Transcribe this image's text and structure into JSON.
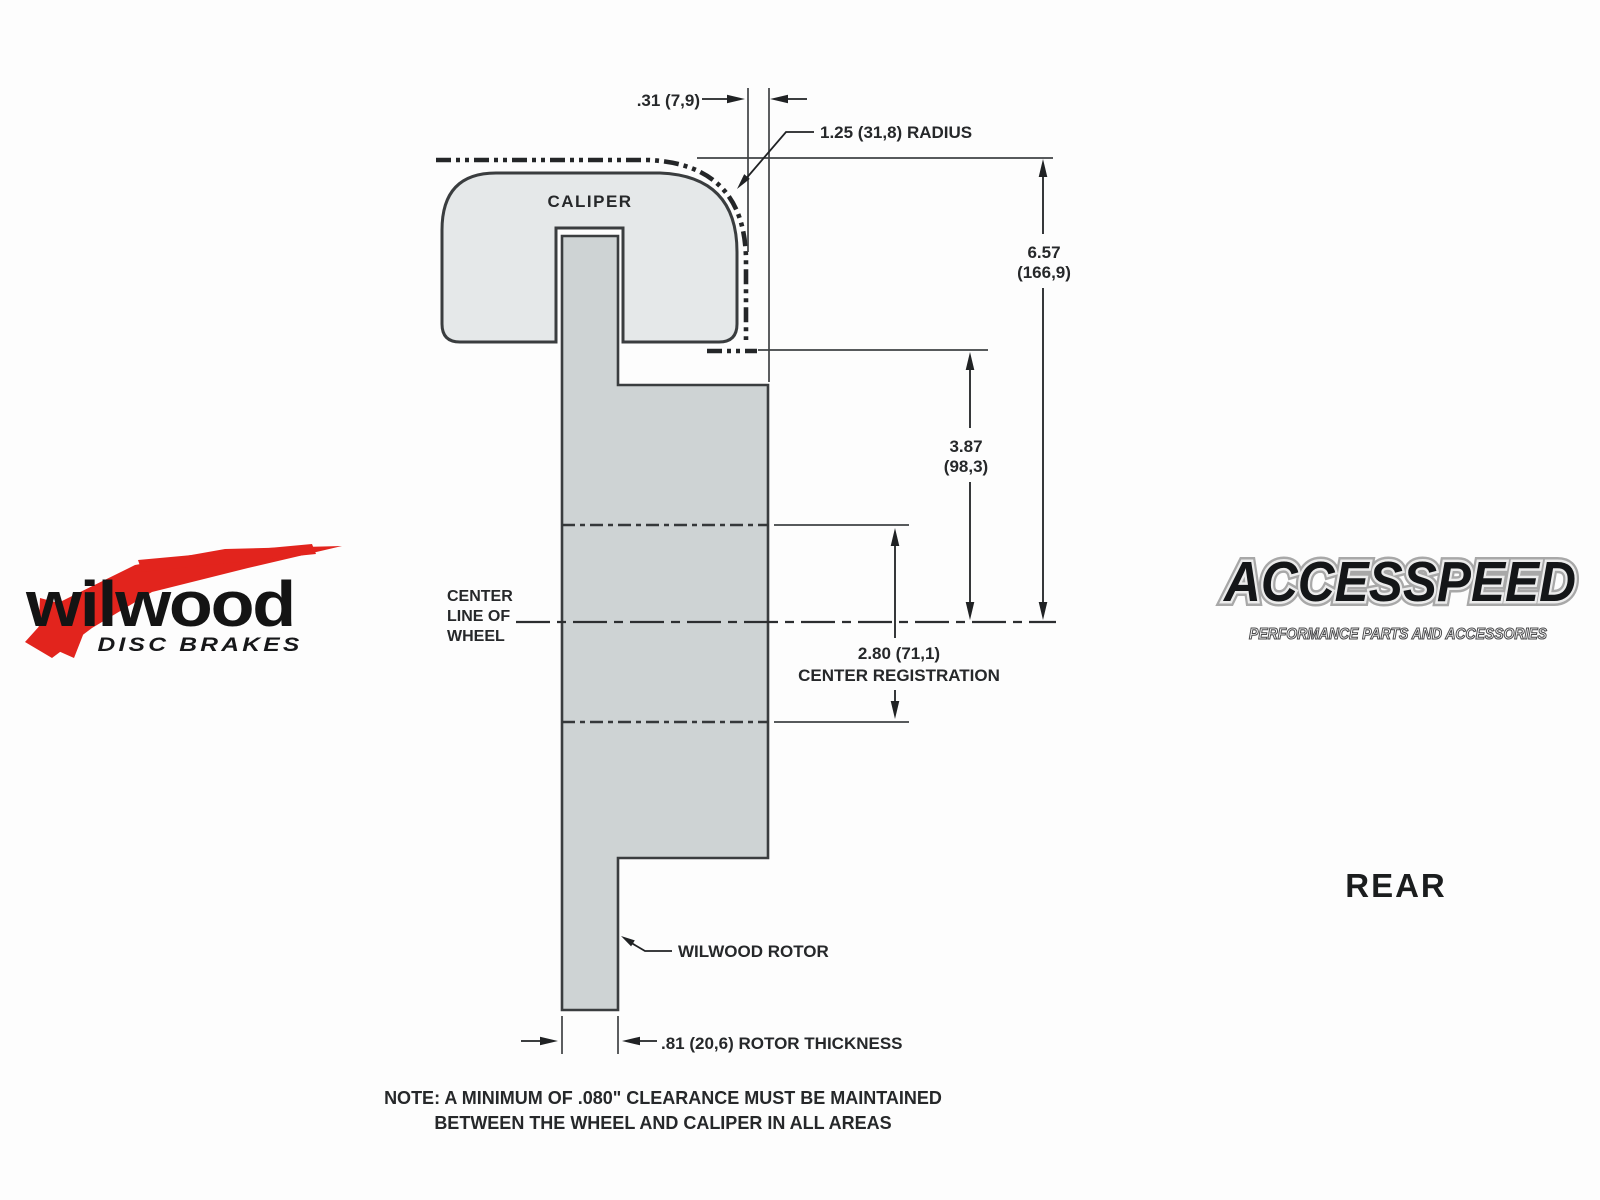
{
  "colors": {
    "background": "#fdfdfd",
    "caliper_fill": "#e5e8e9",
    "rotor_fill": "#ced3d4",
    "line": "#3a3d3f",
    "text": "#26282a",
    "wilwood_red": "#e2241d",
    "logo_dark": "#141618"
  },
  "diagram": {
    "caliper_label": "CALIPER",
    "rotor_label": "WILWOOD ROTOR",
    "centerline_label": {
      "line1": "CENTER",
      "line2": "LINE OF",
      "line3": "WHEEL"
    },
    "dimensions": {
      "wheel_to_hat_gap": ".31 (7,9)",
      "wheel_radius": "1.25 (31,8) RADIUS",
      "overall_height_in": "6.57",
      "overall_height_mm": "(166,9)",
      "lip_to_center_in": "3.87",
      "lip_to_center_mm": "(98,3)",
      "registration_value": "2.80 (71,1)",
      "registration_label": "CENTER REGISTRATION",
      "rotor_thickness": ".81 (20,6) ROTOR THICKNESS"
    },
    "note": {
      "line1": "NOTE: A MINIMUM OF .080\" CLEARANCE MUST BE MAINTAINED",
      "line2": "BETWEEN THE WHEEL AND CALIPER IN ALL AREAS"
    }
  },
  "branding": {
    "wilwood": {
      "name": "wilwood",
      "tagline": "DISC BRAKES"
    },
    "accesspeed": {
      "name": "ACCESSPEED",
      "tagline": "PERFORMANCE PARTS AND ACCESSORIES"
    },
    "view_label": "REAR"
  }
}
